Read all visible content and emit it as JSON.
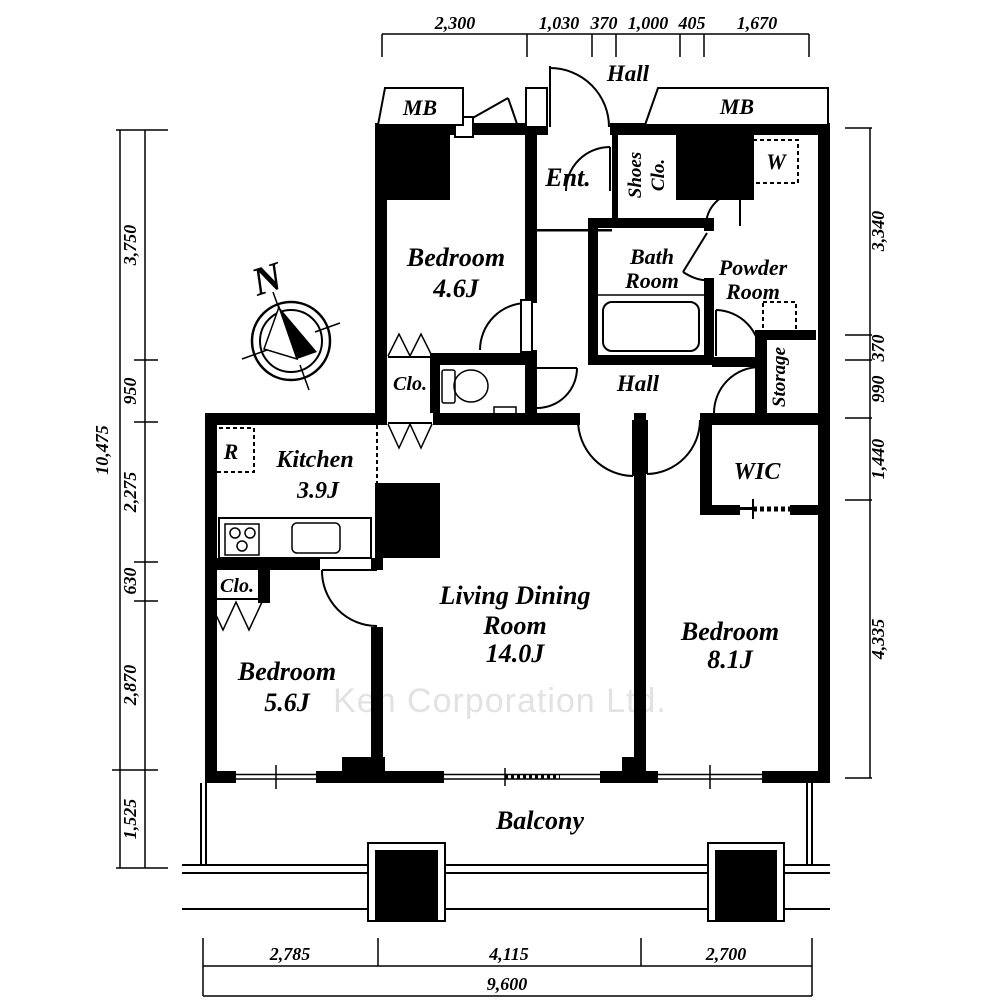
{
  "watermark": "Ken Corporation Ltd.",
  "compass": {
    "north": "N"
  },
  "rooms": {
    "hall_outer": "Hall",
    "mb_left": "MB",
    "mb_right": "MB",
    "entrance": "Ent.",
    "shoes_line1": "Shoes",
    "shoes_line2": "Clo.",
    "washer": "W",
    "bath_line1": "Bath",
    "bath_line2": "Room",
    "powder_line1": "Powder",
    "powder_line2": "Room",
    "hall_inner": "Hall",
    "storage": "Storage",
    "closet_toilet": "Clo.",
    "bedroom1_name": "Bedroom",
    "bedroom1_size": "4.6J",
    "kitchen_name": "Kitchen",
    "kitchen_size": "3.9J",
    "fridge": "R",
    "wic": "WIC",
    "living_line1": "Living Dining",
    "living_line2": "Room",
    "living_size": "14.0J",
    "bedroom3_name": "Bedroom",
    "bedroom3_size": "8.1J",
    "closet_bedroom2": "Clo.",
    "bedroom2_name": "Bedroom",
    "bedroom2_size": "5.6J",
    "balcony": "Balcony"
  },
  "dimensions": {
    "top": [
      "2,300",
      "1,030",
      "370",
      "1,000",
      "405",
      "1,670"
    ],
    "left": [
      "3,750",
      "950",
      "2,275",
      "630",
      "2,870",
      "1,525"
    ],
    "left_total": "10,475",
    "right": [
      "3,340",
      "370",
      "990",
      "1,440",
      "4,335"
    ],
    "bottom": [
      "2,785",
      "4,115",
      "2,700"
    ],
    "bottom_total": "9,600"
  }
}
